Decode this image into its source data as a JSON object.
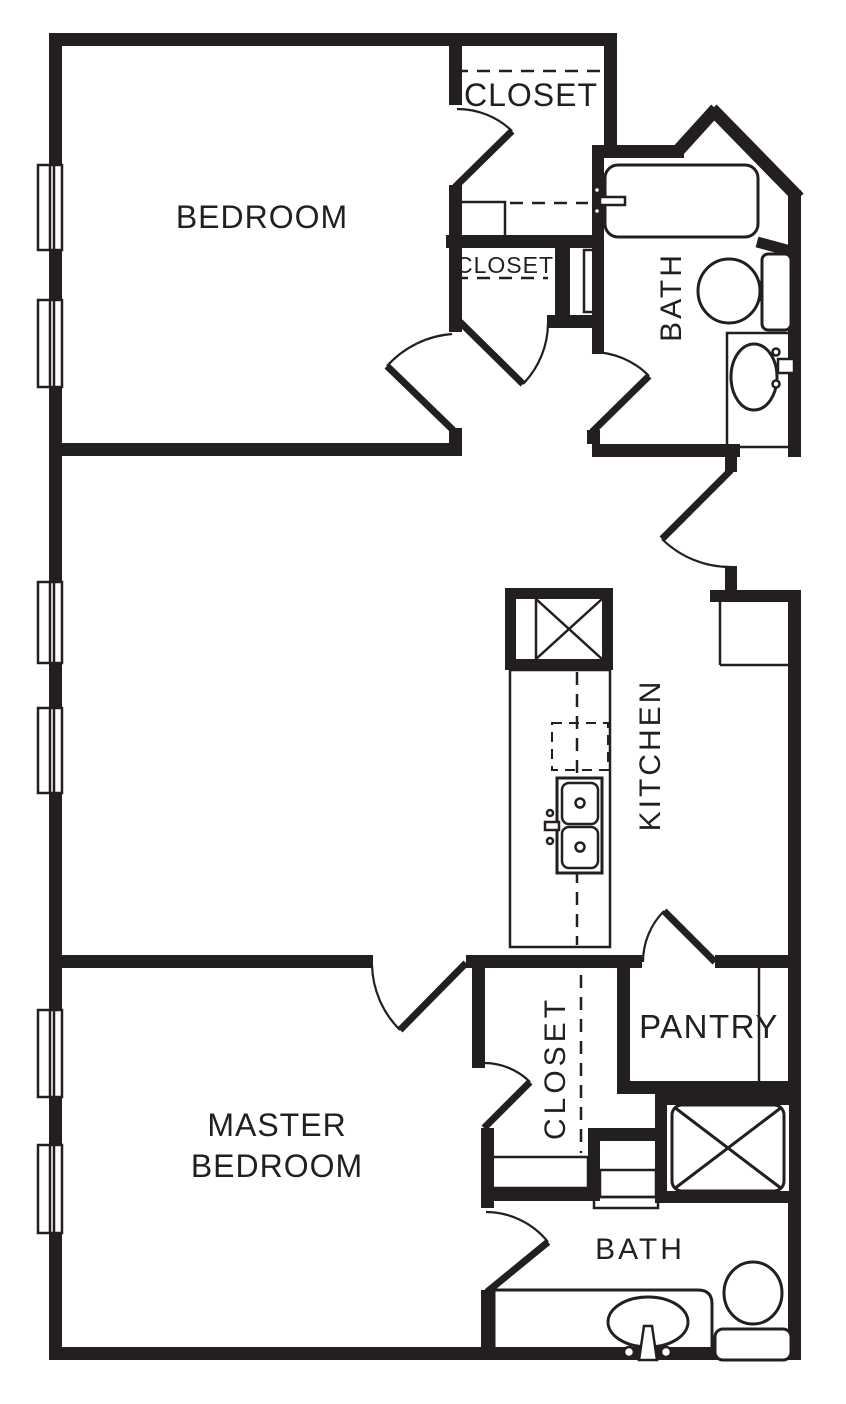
{
  "document": {
    "type": "apartment-floor-plan",
    "colors": {
      "ink": "#231f20",
      "paper": "#ffffff"
    }
  },
  "labels": {
    "bedroom": "BEDROOM",
    "closet_top": "CLOSET",
    "closet_hall": "CLOSET",
    "bath_upper": "BATH",
    "kitchen": "KITCHEN",
    "master_line1": "MASTER",
    "master_line2": "BEDROOM",
    "closet_master": "CLOSET",
    "pantry": "PANTRY",
    "bath_master": "BATH"
  }
}
